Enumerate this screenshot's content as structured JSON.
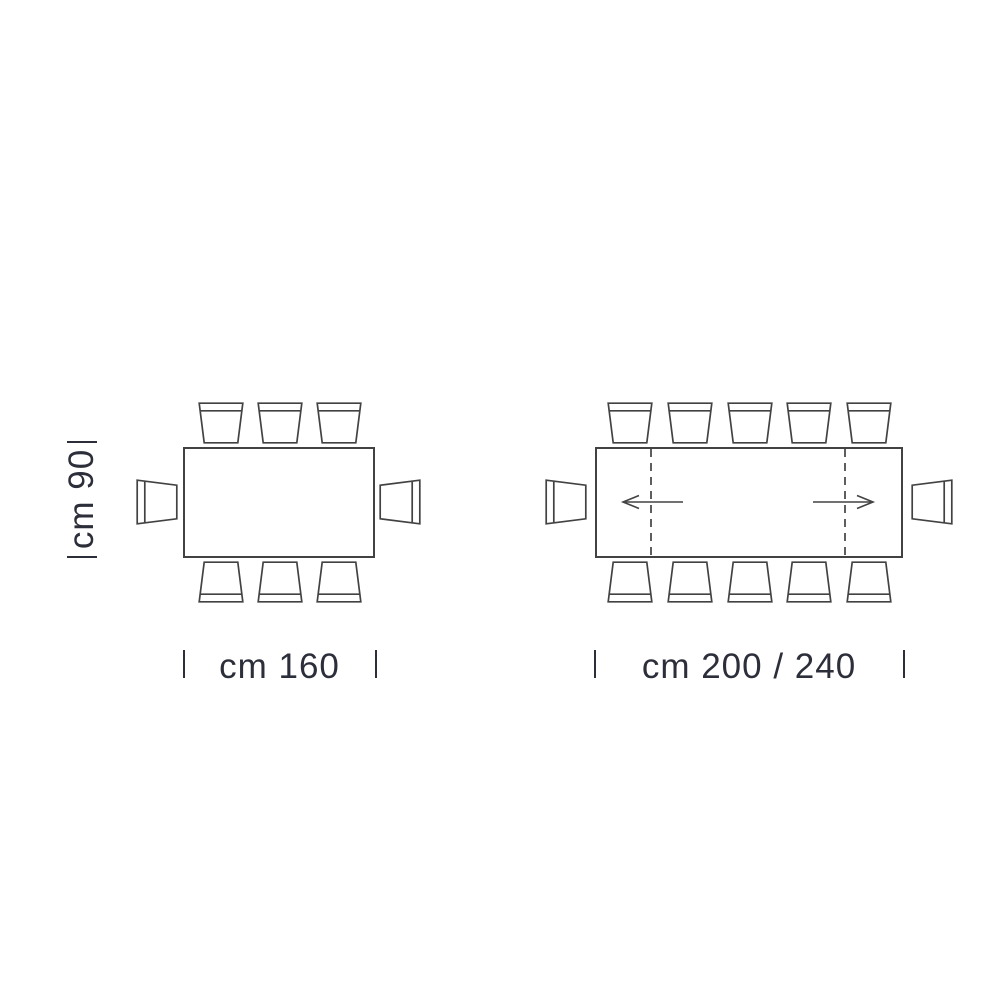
{
  "colors": {
    "background": "#ffffff",
    "line": "#424242",
    "text": "#2c2e3a"
  },
  "diagram_left": {
    "id": "table-cm-160",
    "depth_label": "cm 90",
    "width_label": "cm 160",
    "chairs": {
      "top": 3,
      "bottom": 3,
      "left": 1,
      "right": 1
    }
  },
  "diagram_right": {
    "id": "table-cm-200-240",
    "width_label": "cm 200 / 240",
    "chairs": {
      "top": 5,
      "bottom": 5,
      "left": 1,
      "right": 1
    },
    "extension": {
      "dashed_leaf_lines": 2,
      "arrows": [
        "left",
        "right"
      ]
    }
  }
}
